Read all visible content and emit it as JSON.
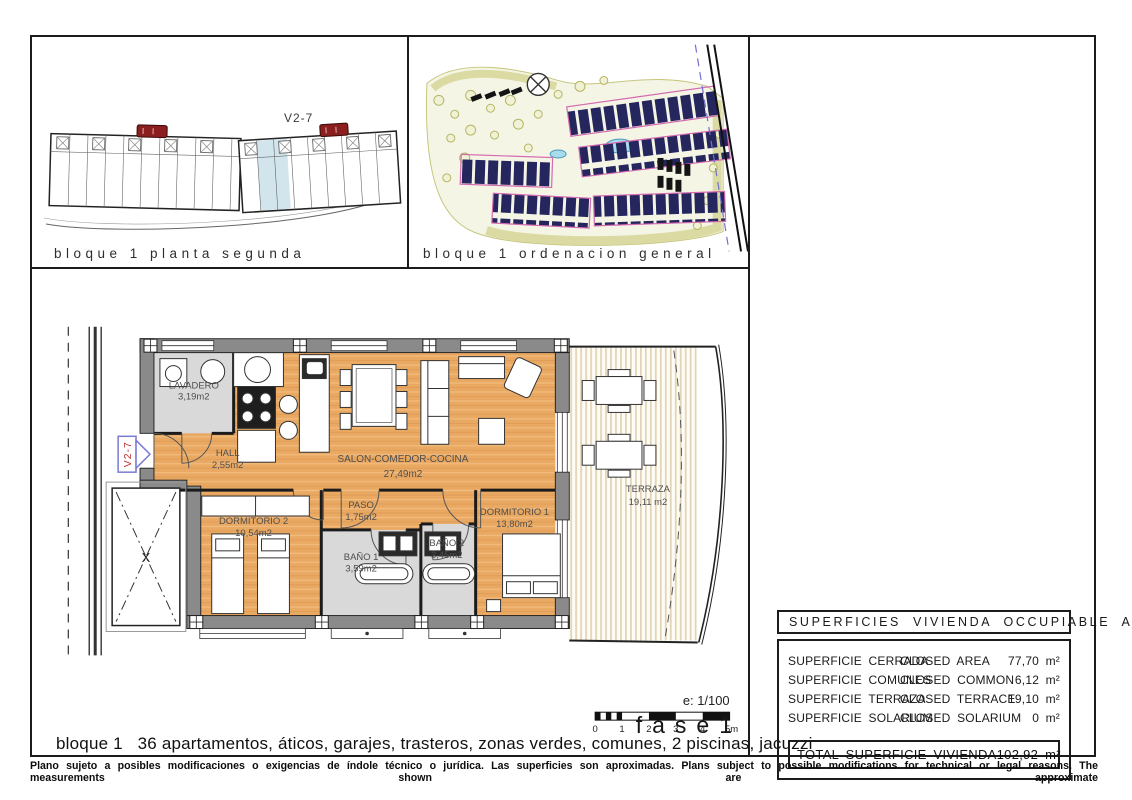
{
  "page": {
    "unit": "V2-7",
    "phase": "fase1",
    "scale_label": "e: 1/100",
    "scale_ticks": [
      "0",
      "1",
      "2",
      "3",
      "4",
      "5m"
    ],
    "caption": "bloque 1   36 apartamentos, áticos, garajes, trasteros, zonas verdes, comunes, 2 piscinas, jacuzzi",
    "disclaimer": "Plano sujeto a posibles modificaciones o exigencias de índole técnico o jurídica. Las superficies son aproximadas. Plans subject to possible modifications for technical or legal reasons. The measurements shown are approximate"
  },
  "panels": {
    "block_plan": {
      "caption": "bloque 1 planta segunda"
    },
    "site_plan": {
      "caption": "bloque 1 ordenacion general"
    }
  },
  "rooms": {
    "lavadero": {
      "name": "LAVADERO",
      "area": "3,19m2"
    },
    "hall": {
      "name": "HALL",
      "area": "2,55m2"
    },
    "salon": {
      "name": "SALON-COMEDOR-COCINA",
      "area": "27,49m2"
    },
    "paso": {
      "name": "PASO",
      "area": "1,75m2"
    },
    "dormitorio2": {
      "name": "DORMITORIO 2",
      "area": "10,54m2"
    },
    "dormitorio1": {
      "name": "DORMITORIO 1",
      "area": "13,80m2"
    },
    "bano1": {
      "name": "BAÑO 1",
      "area": "3,59m2"
    },
    "bano2": {
      "name": "BAÑO 2",
      "area": "3,45m2"
    },
    "terraza": {
      "name": "TERRAZA",
      "area": "19,11 m2"
    }
  },
  "area_table": {
    "title": "SUPERFICIES VIVIENDA OCCUPIABLE AREA",
    "rows": [
      {
        "es": "SUPERFICIE CERRADA",
        "en": "CLOSED AREA",
        "value": "77,70 m²"
      },
      {
        "es": "SUPERFICIE COMUNES",
        "en": "CLOSED COMMON",
        "value": "6,12 m²"
      },
      {
        "es": "SUPERFICIE TERRAZA",
        "en": "CLOSED TERRACE",
        "value": "19,10 m²"
      },
      {
        "es": "SUPERFICIE SOLARIUM",
        "en": "CLOSED SOLARIUM",
        "value": "0 m²"
      }
    ],
    "total_label": "TOTAL SUPERFICIE VIVIENDA",
    "total_value": "102,92 m²"
  },
  "colors": {
    "floor_orange": "#e9a963",
    "floor_gray": "#d9d9d9",
    "wall_gray": "#8a8a8a",
    "terrace_stripe": "#e2d4b6",
    "site_green_edge": "#c6c67e",
    "site_navy": "#26265e",
    "site_pink": "#d46ab0",
    "accent_red": "#8b1f1f",
    "marker_blue": "#7a7ad8",
    "marker_red": "#c23030"
  }
}
